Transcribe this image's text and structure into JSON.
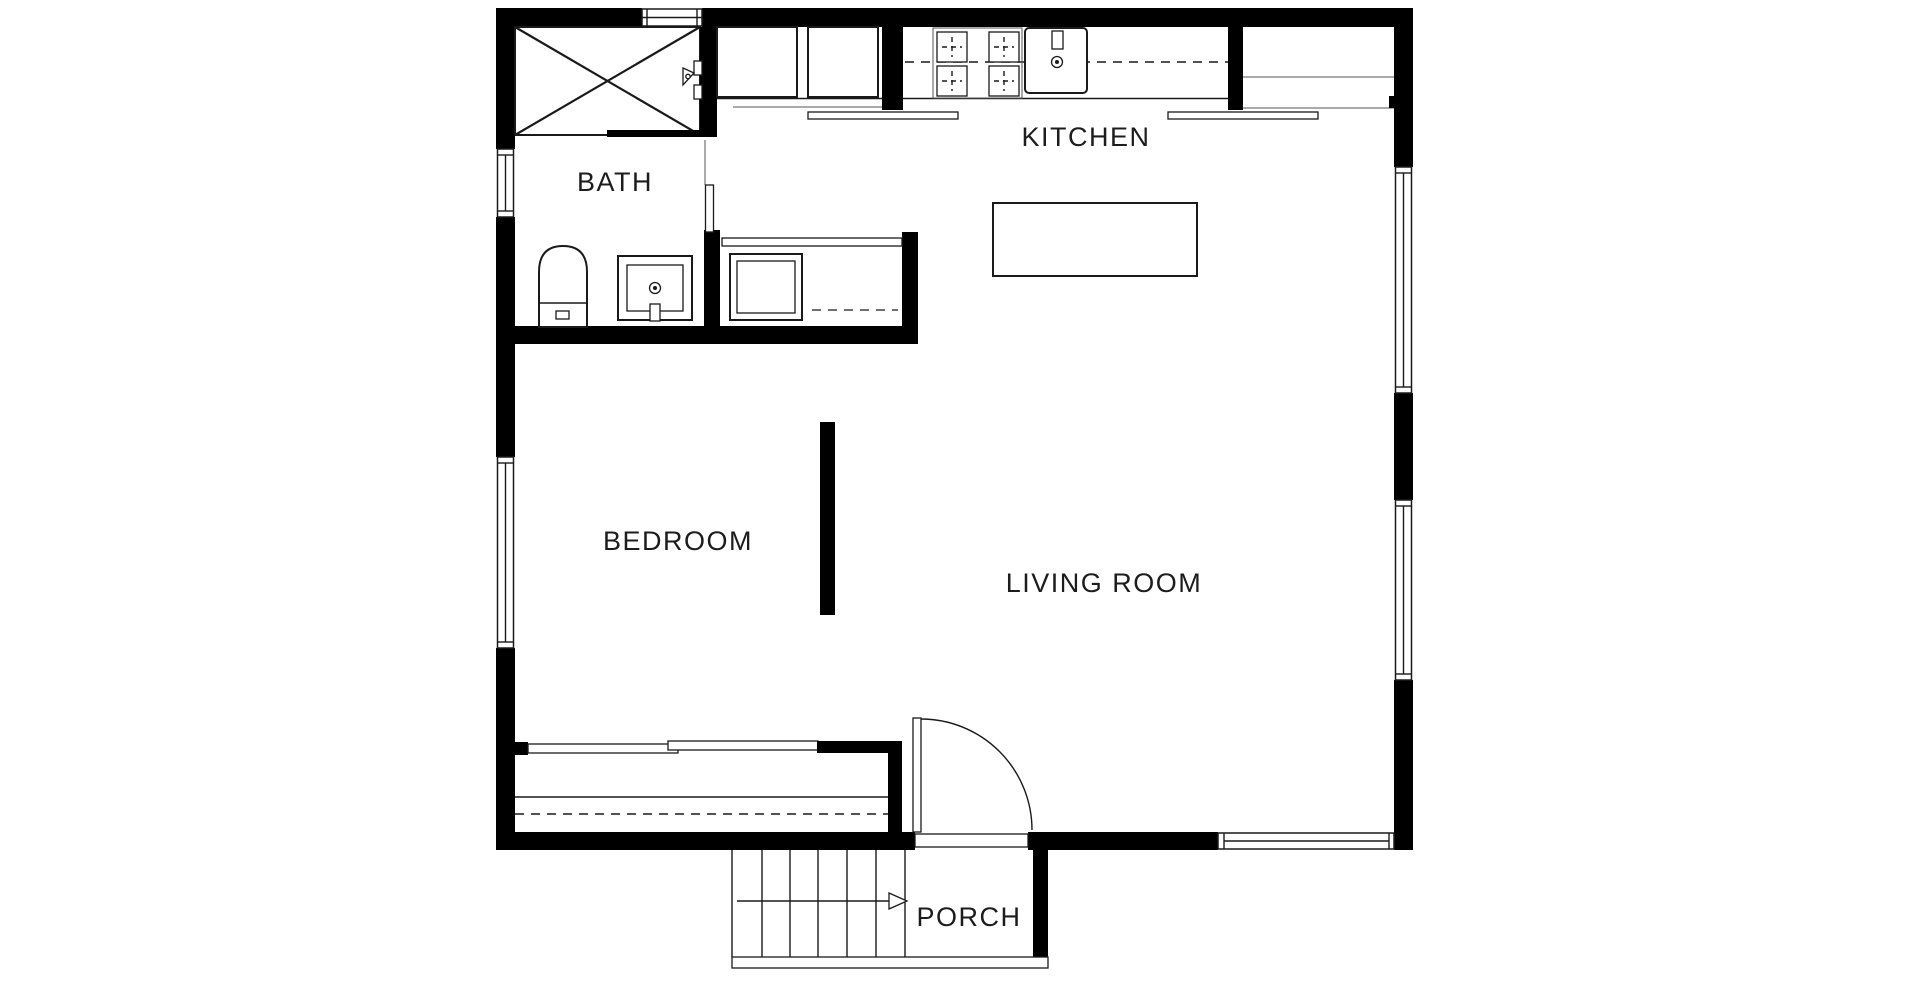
{
  "title": "Floor plan",
  "colors": {
    "background": "#ffffff",
    "walls": "#000000",
    "lines": "#1a1a1a",
    "labels": "#1c1c1c"
  },
  "rooms": {
    "bath": {
      "label": "BATH"
    },
    "kitchen": {
      "label": "KITCHEN"
    },
    "bedroom": {
      "label": "BEDROOM"
    },
    "living_room": {
      "label": "LIVING ROOM"
    },
    "porch": {
      "label": "PORCH"
    }
  },
  "fixtures": [
    "shower",
    "shower-head",
    "toilet",
    "bathroom-sink",
    "bath-door",
    "closet-shelf",
    "washer",
    "refrigerator",
    "cabinet",
    "cooktop-4-burner",
    "kitchen-sink",
    "kitchen-counter",
    "kitchen-island",
    "room-divider-wall",
    "sliding-door",
    "deck-strip",
    "entry-door",
    "stairs",
    "stair-arrow",
    "porch-rail"
  ],
  "windows": {
    "top_wall": 1,
    "left_wall": 2,
    "right_wall": 2,
    "bottom_wall": 1
  },
  "stairs": {
    "treads": 6,
    "direction_arrow": "right"
  }
}
